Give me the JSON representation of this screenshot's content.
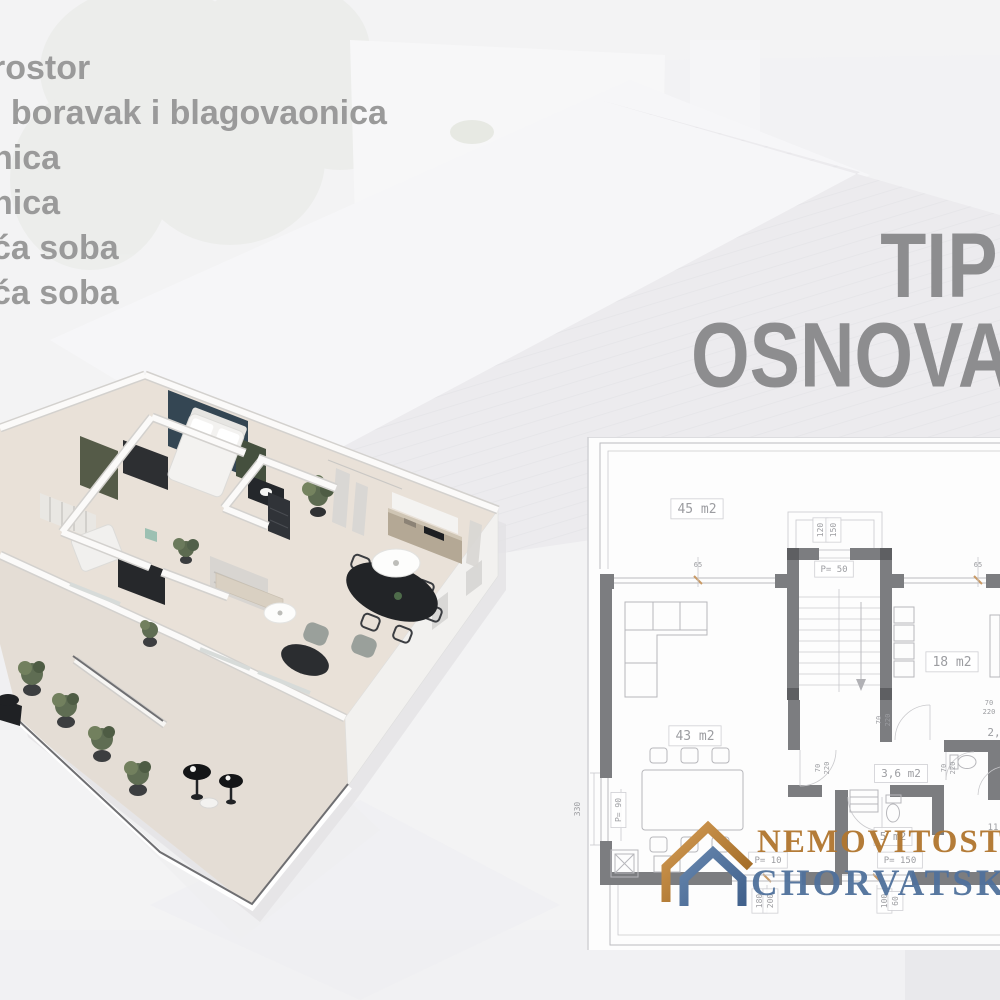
{
  "colors": {
    "list_text": "#9a9a9a",
    "heading_text": "#8d8d8f",
    "plan_wall": "#7c7d80",
    "accent_navy": "#344653",
    "accent_olive": "#555b48",
    "logo_gold": "#b1762e",
    "logo_blue": "#50719c"
  },
  "room_list": {
    "items": [
      {
        "text": "rostor"
      },
      {
        "text": "i boravak i blagovaonica"
      },
      {
        "text": "nica"
      },
      {
        "text": "nica"
      },
      {
        "text": "ća soba"
      },
      {
        "text": "ća soba"
      },
      {
        "text": "a",
        "dx": -14
      }
    ]
  },
  "heading": {
    "line1": "TIP",
    "line2": "OSNOVA"
  },
  "logo": {
    "line1": "NEMOVITOST",
    "line2": "CHORVATSKO"
  },
  "plan": {
    "labels": [
      {
        "t": "45 m2",
        "x": 127,
        "y": 76,
        "s": 13,
        "box": true
      },
      {
        "t": "P= 50",
        "x": 264,
        "y": 135,
        "s": 9,
        "box": true
      },
      {
        "t": "120",
        "x": 253,
        "y": 93,
        "s": 8,
        "r": -90,
        "box": true
      },
      {
        "t": "150",
        "x": 266,
        "y": 93,
        "s": 8,
        "r": -90,
        "box": true
      },
      {
        "t": "65",
        "x": 128,
        "y": 130,
        "s": 7
      },
      {
        "t": "65",
        "x": 408,
        "y": 130,
        "s": 7
      },
      {
        "t": "18 m2",
        "x": 382,
        "y": 229,
        "s": 13,
        "box": true
      },
      {
        "t": "43 m2",
        "x": 125,
        "y": 303,
        "s": 13,
        "box": true
      },
      {
        "t": "3,6 m2",
        "x": 331,
        "y": 340,
        "s": 11,
        "box": true
      },
      {
        "t": "2,",
        "x": 424,
        "y": 299,
        "s": 11
      },
      {
        "t": "11",
        "x": 423,
        "y": 393,
        "s": 9
      },
      {
        "t": "5 m2",
        "x": 323,
        "y": 403,
        "s": 11,
        "box": true
      },
      {
        "t": "P= 10",
        "x": 198,
        "y": 426,
        "s": 9,
        "box": true
      },
      {
        "t": "P= 150",
        "x": 330,
        "y": 426,
        "s": 9,
        "box": true
      },
      {
        "t": "P= 90",
        "x": 51,
        "y": 373,
        "s": 8,
        "r": -90,
        "box": true
      },
      {
        "t": "330",
        "x": 10,
        "y": 372,
        "s": 8,
        "r": -90
      },
      {
        "t": "180",
        "x": 192,
        "y": 464,
        "s": 8,
        "r": -90,
        "box": true
      },
      {
        "t": "200",
        "x": 203,
        "y": 464,
        "s": 8,
        "r": -90,
        "box": true
      },
      {
        "t": "100",
        "x": 317,
        "y": 464,
        "s": 8,
        "r": -90,
        "box": true
      },
      {
        "t": "60",
        "x": 328,
        "y": 464,
        "s": 8,
        "r": -90,
        "box": true
      },
      {
        "t": "70",
        "x": 250,
        "y": 331,
        "s": 7,
        "r": -90
      },
      {
        "t": "220",
        "x": 259,
        "y": 331,
        "s": 7,
        "r": -90
      },
      {
        "t": "70",
        "x": 376,
        "y": 331,
        "s": 7,
        "r": -90
      },
      {
        "t": "220",
        "x": 385,
        "y": 331,
        "s": 7,
        "r": -90
      },
      {
        "t": "70",
        "x": 311,
        "y": 283,
        "s": 7,
        "r": -90
      },
      {
        "t": "220",
        "x": 320,
        "y": 283,
        "s": 7,
        "r": -90
      },
      {
        "t": "70",
        "x": 419,
        "y": 268,
        "s": 7
      },
      {
        "t": "220",
        "x": 419,
        "y": 277,
        "s": 7
      }
    ]
  }
}
